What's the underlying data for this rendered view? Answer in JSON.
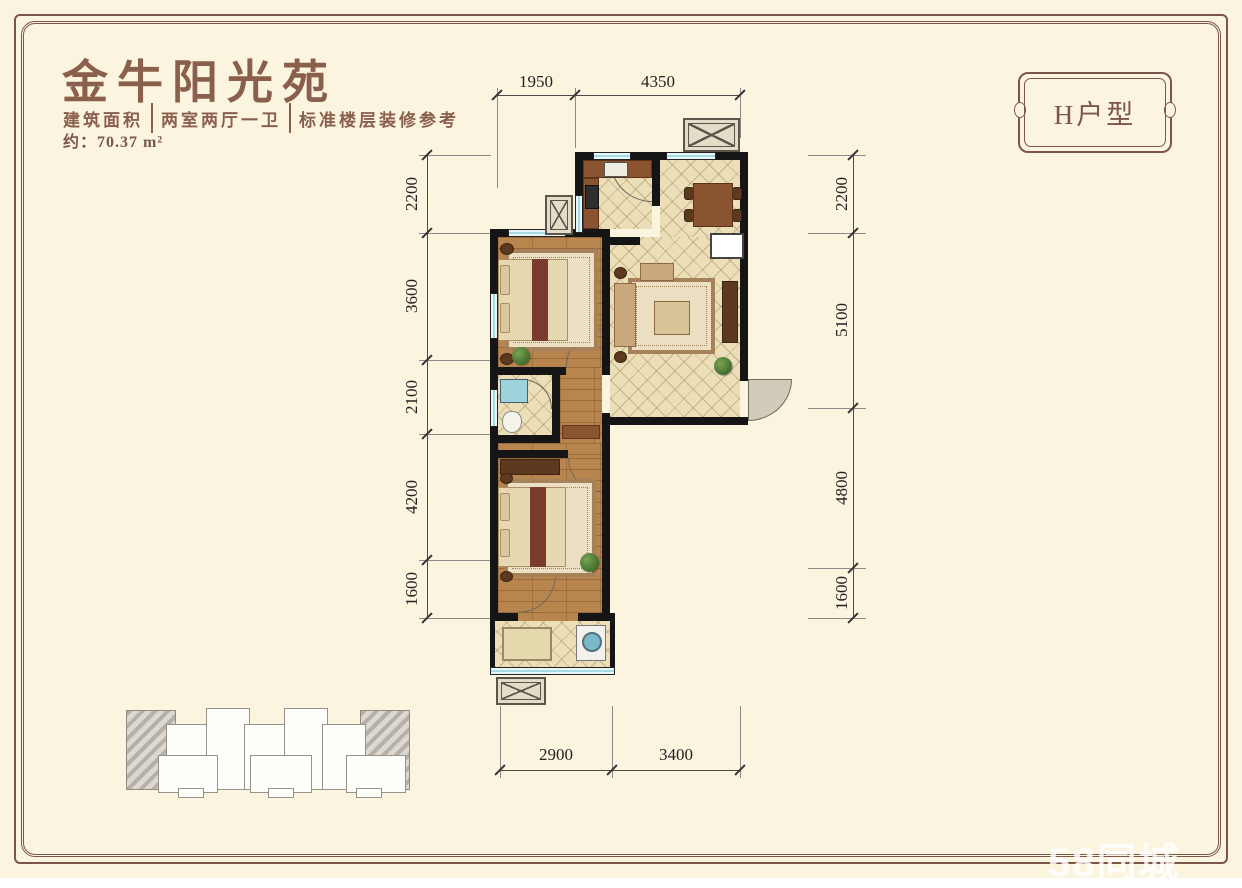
{
  "header": {
    "title": "金牛阳光苑",
    "area_label": "建筑面积",
    "area_value": "约：70.37 m²",
    "unit_layout": "两室两厅一卫",
    "note": "标准楼层装修参考"
  },
  "badge": {
    "label": "H户型"
  },
  "dimensions": {
    "top": [
      "1950",
      "4350"
    ],
    "left": [
      "2200",
      "3600",
      "2100",
      "4200",
      "1600"
    ],
    "right": [
      "2200",
      "5100",
      "4800",
      "1600"
    ],
    "bottom": [
      "2900",
      "3400"
    ]
  },
  "watermark": "58同城",
  "colors": {
    "background": "#fbf4df",
    "frame": "#7d564a",
    "title_text": "#8a5f4c",
    "wall": "#151515",
    "window": "#a6dae4",
    "wood_floor": "#b9854e",
    "tile_floor": "#ecdfb8",
    "dimension_text": "#222222",
    "watermark_text": "#ffffff"
  }
}
